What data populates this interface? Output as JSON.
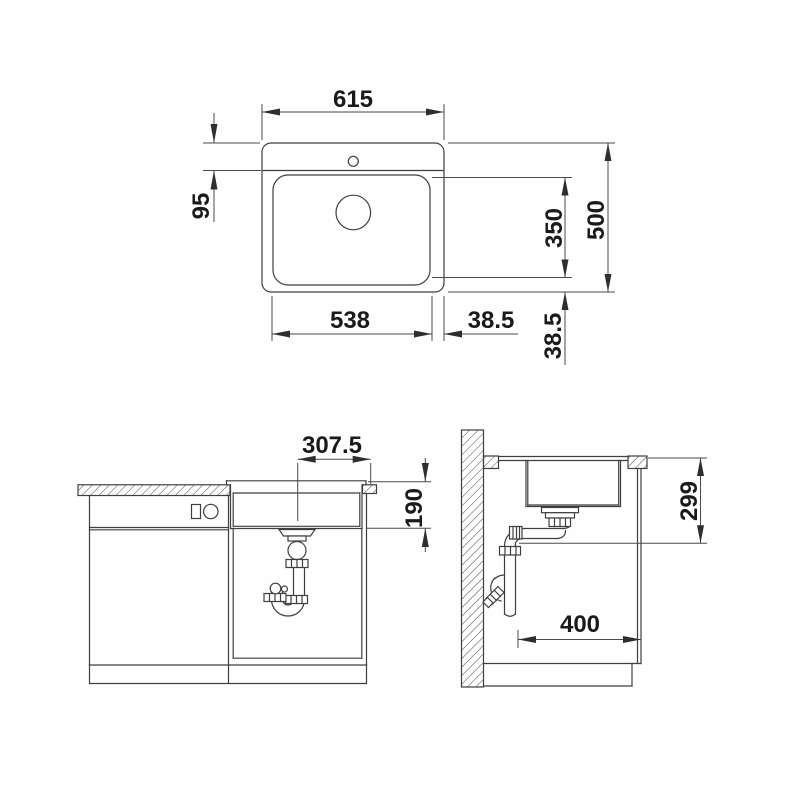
{
  "drawing": {
    "description": "Sink installation technical drawing with plan view, front elevation and side section",
    "line_color": "#3f3f3f",
    "text_color": "#1a1a1a",
    "background": "#fefefe",
    "views": {
      "top_view": {
        "name": "plan-view",
        "dimensions": {
          "overall_width": "615",
          "rim_to_bowl": "95",
          "bowl_length": "350",
          "overall_depth": "500",
          "bowl_width": "538",
          "edge_offset_right": "38.5",
          "edge_offset_bottom": "38.5"
        }
      },
      "front_view": {
        "name": "front-elevation",
        "dimensions": {
          "drain_center_to_edge": "307.5",
          "bowl_depth": "190"
        }
      },
      "side_view": {
        "name": "side-section",
        "dimensions": {
          "worktop_to_outlet": "299",
          "wall_to_front": "400"
        }
      }
    }
  }
}
